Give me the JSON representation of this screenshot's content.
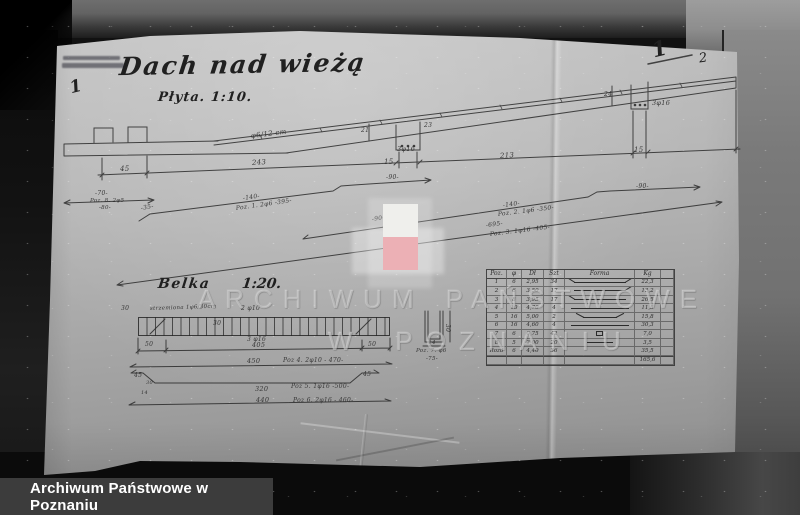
{
  "drawing": {
    "title": "Dach nad wieżą",
    "subtitle": "Płyta. 1:10.",
    "beam_title": "Belka",
    "beam_scale": "1:20.",
    "ink_color": "#262626",
    "annotations": [
      {
        "t": "φ6/12 cm",
        "x": 251,
        "y": 133,
        "r": -7,
        "s": 7
      },
      {
        "t": "45",
        "x": 120,
        "y": 166,
        "s": 7
      },
      {
        "t": "243",
        "x": 252,
        "y": 160,
        "r": -4,
        "s": 7
      },
      {
        "t": "15",
        "x": 384,
        "y": 159,
        "s": 7
      },
      {
        "t": "213",
        "x": 500,
        "y": 153,
        "r": -4,
        "s": 7
      },
      {
        "t": "15",
        "x": 634,
        "y": 147,
        "s": 7
      },
      {
        "t": "21",
        "x": 361,
        "y": 128,
        "s": 6
      },
      {
        "t": "23",
        "x": 424,
        "y": 123,
        "s": 6
      },
      {
        "t": "3φ16",
        "x": 397,
        "y": 146,
        "s": 6.5
      },
      {
        "t": "24",
        "x": 604,
        "y": 92,
        "s": 6
      },
      {
        "t": "3φ16",
        "x": 652,
        "y": 100,
        "s": 6.5
      },
      {
        "t": "-70-",
        "x": 95,
        "y": 191,
        "s": 6
      },
      {
        "t": "Poz. 8. 2φ5",
        "x": 90,
        "y": 199,
        "s": 5.5
      },
      {
        "t": "-80-",
        "x": 99,
        "y": 206,
        "s": 5.5
      },
      {
        "t": "-35-",
        "x": 141,
        "y": 206,
        "r": -10,
        "s": 6
      },
      {
        "t": "-140-",
        "x": 243,
        "y": 196,
        "r": -8,
        "s": 6
      },
      {
        "t": "Poz. 1. 2φ6 -395-",
        "x": 236,
        "y": 206,
        "r": -8,
        "s": 6
      },
      {
        "t": "-90-",
        "x": 386,
        "y": 175,
        "s": 6
      },
      {
        "t": "-90-",
        "x": 372,
        "y": 217,
        "r": -8,
        "s": 6
      },
      {
        "t": "-140-",
        "x": 503,
        "y": 203,
        "r": -7,
        "s": 6
      },
      {
        "t": "Poz. 2. 1φ6 -350-",
        "x": 498,
        "y": 212,
        "r": -7,
        "s": 6
      },
      {
        "t": "-90-",
        "x": 636,
        "y": 184,
        "s": 6
      },
      {
        "t": "-695-",
        "x": 486,
        "y": 223,
        "r": -7,
        "s": 6
      },
      {
        "t": "Poz. 3. 1φ16 -405-",
        "x": 490,
        "y": 232,
        "r": -7,
        "s": 6
      },
      {
        "t": "30",
        "x": 121,
        "y": 306,
        "s": 6
      },
      {
        "t": "strzemiona 1φ6/30cm",
        "x": 150,
        "y": 307,
        "r": -2,
        "s": 5.5
      },
      {
        "t": "2 φ10",
        "x": 241,
        "y": 306,
        "s": 6
      },
      {
        "t": "30",
        "x": 213,
        "y": 321,
        "s": 6
      },
      {
        "t": "3 φ16",
        "x": 247,
        "y": 337,
        "s": 6
      },
      {
        "t": "50",
        "x": 145,
        "y": 342,
        "s": 6
      },
      {
        "t": "405",
        "x": 252,
        "y": 342,
        "s": 6.5
      },
      {
        "t": "50",
        "x": 368,
        "y": 342,
        "s": 6
      },
      {
        "t": "450",
        "x": 247,
        "y": 358,
        "s": 6.5
      },
      {
        "t": "Poz 4. 2φ10 - 470-",
        "x": 283,
        "y": 358,
        "s": 6
      },
      {
        "t": "45",
        "x": 134,
        "y": 373,
        "s": 6
      },
      {
        "t": "30",
        "x": 146,
        "y": 381,
        "s": 5
      },
      {
        "t": "14",
        "x": 141,
        "y": 391,
        "s": 5
      },
      {
        "t": "320",
        "x": 255,
        "y": 386,
        "s": 6.5
      },
      {
        "t": "Poz 5. 1φ16 -500-",
        "x": 291,
        "y": 384,
        "s": 6
      },
      {
        "t": "45",
        "x": 363,
        "y": 372,
        "s": 6
      },
      {
        "t": "440",
        "x": 256,
        "y": 397,
        "s": 6.5
      },
      {
        "t": "Poz 6. 2φ16 - 460-",
        "x": 293,
        "y": 398,
        "s": 6
      },
      {
        "t": "30",
        "x": 447,
        "y": 321,
        "r": 90,
        "s": 6
      },
      {
        "t": "-14-",
        "x": 426,
        "y": 341,
        "s": 5.5
      },
      {
        "t": "Poz. 7. φ6",
        "x": 416,
        "y": 349,
        "s": 5.5
      },
      {
        "t": "-75-",
        "x": 426,
        "y": 357,
        "s": 5.5
      }
    ]
  },
  "page_marks": {
    "corner_primary": "1",
    "corner_secondary": "2",
    "margin_mark": "1"
  },
  "table": {
    "headers": [
      "Poz.",
      "φ",
      "Dł",
      "Szt",
      "Forma",
      "Kg",
      ""
    ],
    "rows": [
      [
        "1",
        "6",
        "2,95",
        "34",
        {
          "shape": "hooks-up"
        },
        "22,3",
        ""
      ],
      [
        "2",
        "6",
        "3,50",
        "17",
        {
          "shape": "step-right"
        },
        "13,2",
        ""
      ],
      [
        "3",
        "8",
        "3,95",
        "17",
        {
          "shape": "hook-left"
        },
        "26,5",
        ""
      ],
      [
        "4",
        "10",
        "4,70",
        "4",
        {
          "shape": "straight"
        },
        "11,5",
        ""
      ],
      [
        "5",
        "16",
        "5,00",
        "2",
        {
          "shape": "trapezoid"
        },
        "15,8",
        ""
      ],
      [
        "6",
        "16",
        "4,60",
        "4",
        {
          "shape": "straight"
        },
        "30,3",
        ""
      ],
      [
        "7",
        "6",
        "0,75",
        "42",
        {
          "shape": "stirrup"
        },
        "7,0",
        ""
      ],
      [
        "8",
        "5",
        "2,00",
        "20",
        {
          "shape": "short"
        },
        "3,5",
        ""
      ],
      [
        "Rozd",
        "6",
        "4,40",
        "36",
        {
          "shape": "none"
        },
        "35,5",
        ""
      ],
      [
        "",
        "",
        "",
        "",
        {
          "shape": "none"
        },
        "165,6",
        ""
      ]
    ]
  },
  "watermark": {
    "word1": "ARCHIWUM",
    "word2": "PAŃSTWOWE",
    "word3": "W",
    "word4": "POZNANIU",
    "flag_white": "#efefec",
    "flag_red": "#ecb0b5"
  },
  "caption": {
    "text": "Archiwum Państwowe w Poznaniu",
    "bar_color": "#3c3c3c"
  }
}
